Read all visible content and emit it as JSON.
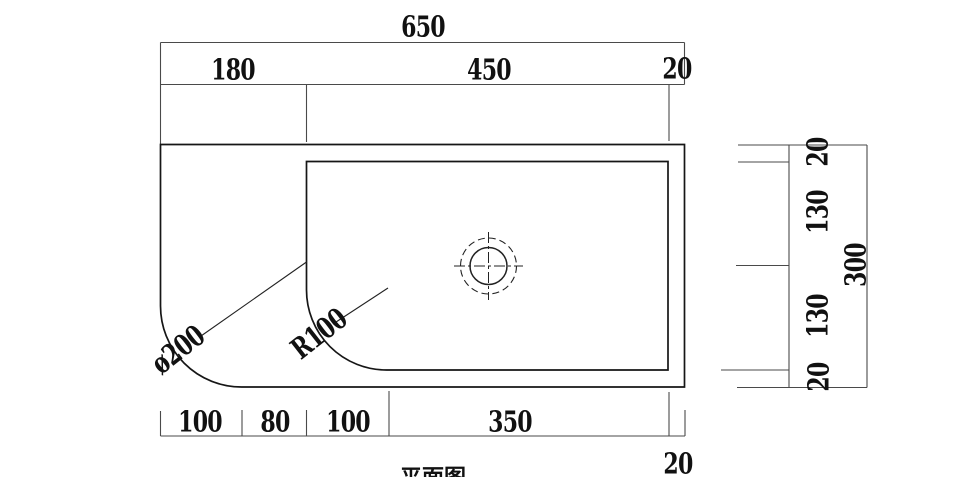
{
  "title": "平面图",
  "colors": {
    "background": "#ffffff",
    "object_line": "#161616",
    "dimension_line": "#4a4a4a",
    "text": "#111111"
  },
  "dims": {
    "top_total": "650",
    "top_segments": [
      "180",
      "450",
      "20"
    ],
    "bottom_segments": [
      "100",
      "80",
      "100",
      "350"
    ],
    "bottom_offset": "20",
    "side_segments": [
      "20",
      "130",
      "130",
      "20"
    ],
    "side_total": "300",
    "corner_diameter": "ø200",
    "corner_radius": "R100"
  }
}
